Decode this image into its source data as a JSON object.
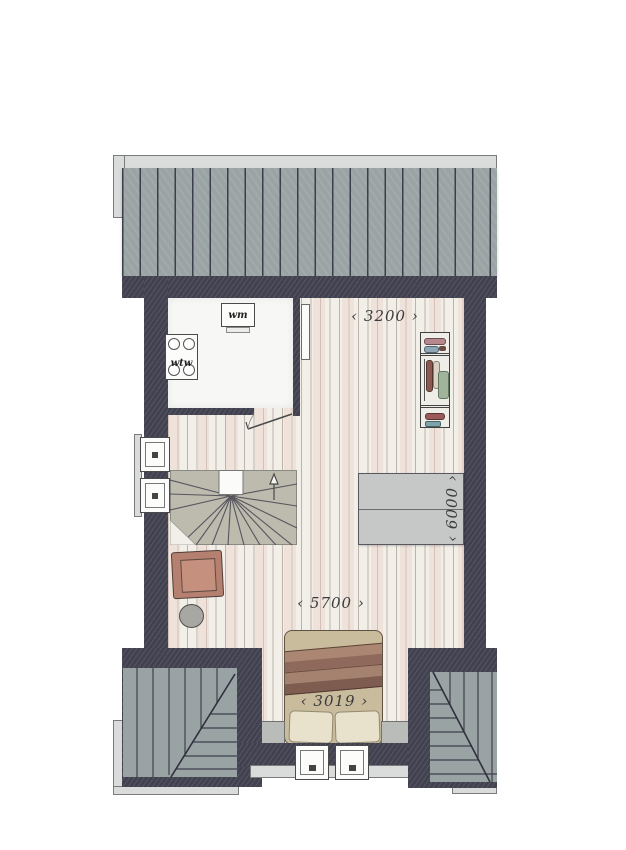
{
  "plan": {
    "type": "floor-plan",
    "labels": {
      "washing_machine": "wm",
      "heat_recovery_unit": "wtw"
    },
    "dimensions": {
      "top": {
        "value": "3200",
        "display": "‹ 3200 ›"
      },
      "right": {
        "value": "6000",
        "display": "‹ 6000 ›"
      },
      "middle": {
        "value": "5700",
        "display": "‹ 5700 ›"
      },
      "bed": {
        "value": "3019",
        "display": "‹ 3019 ›"
      }
    },
    "colors": {
      "wall": "#414150",
      "roof": "#9ba4a4",
      "gutter": "#dadcdb",
      "floor": "#f2efe9",
      "floor_stripe": "#e9d2c8",
      "utility_floor": "#f7f7f5",
      "stairs": "#bdbaae",
      "roof_window": "#c5c8c6",
      "armchair": "#b5806f",
      "side_table": "#a7a7a3",
      "bed_duvet": "#c8bc9d",
      "bed_blanket": "#8f6a5c",
      "pillow": "#e8e1cc",
      "knee_wall": "#babcb9"
    },
    "icons": [
      "roof-icon",
      "gutter-icon",
      "exterior-wall",
      "wood-floor",
      "utility-room",
      "washing-machine-icon",
      "wtw-unit-icon",
      "radiator-icon",
      "door-swing-icon",
      "wardrobe-icon",
      "stairs-icon",
      "direction-arrow-icon",
      "roof-window-icon",
      "window-icon",
      "armchair-icon",
      "side-table-icon",
      "double-bed-icon",
      "pillow-icon",
      "hip-roof-left",
      "hip-roof-right",
      "knee-wall"
    ]
  }
}
